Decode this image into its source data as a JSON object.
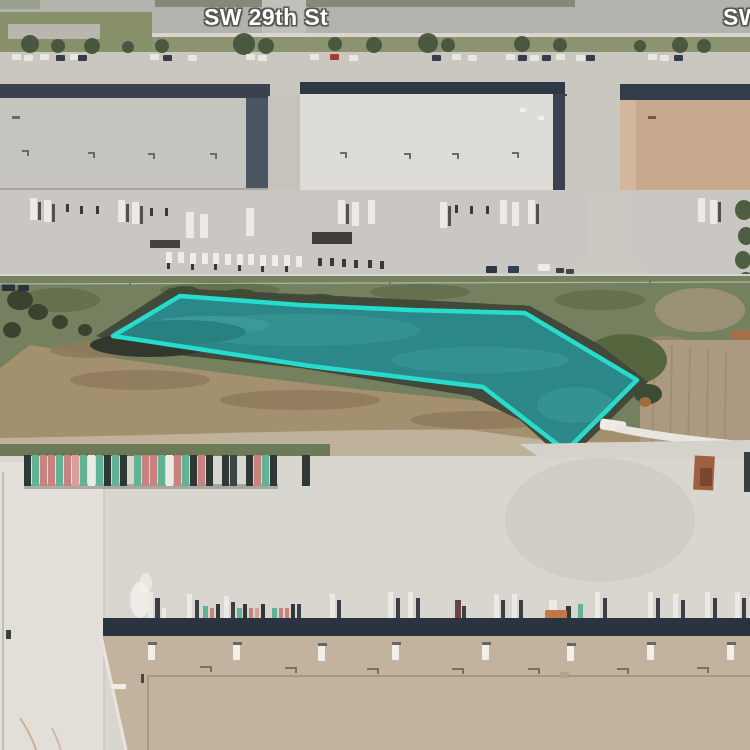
{
  "labels": {
    "street_main": "SW 29th St",
    "street_right_clipped": "SW 29th St"
  },
  "highlight": {
    "shape": "polygon",
    "points": "113,336 180,296 300,305 410,310 525,313 637,380 566,451 483,387 310,366",
    "stroke_color": "#27dccd",
    "fill_color": "rgba(39,220,205,0.15)",
    "stroke_width": "4.5"
  },
  "palette": {
    "highlight_teal": "#27dccd",
    "pond_water": "#2d7a7c",
    "label_text": "#ffffff",
    "label_outline": "#56544f"
  }
}
